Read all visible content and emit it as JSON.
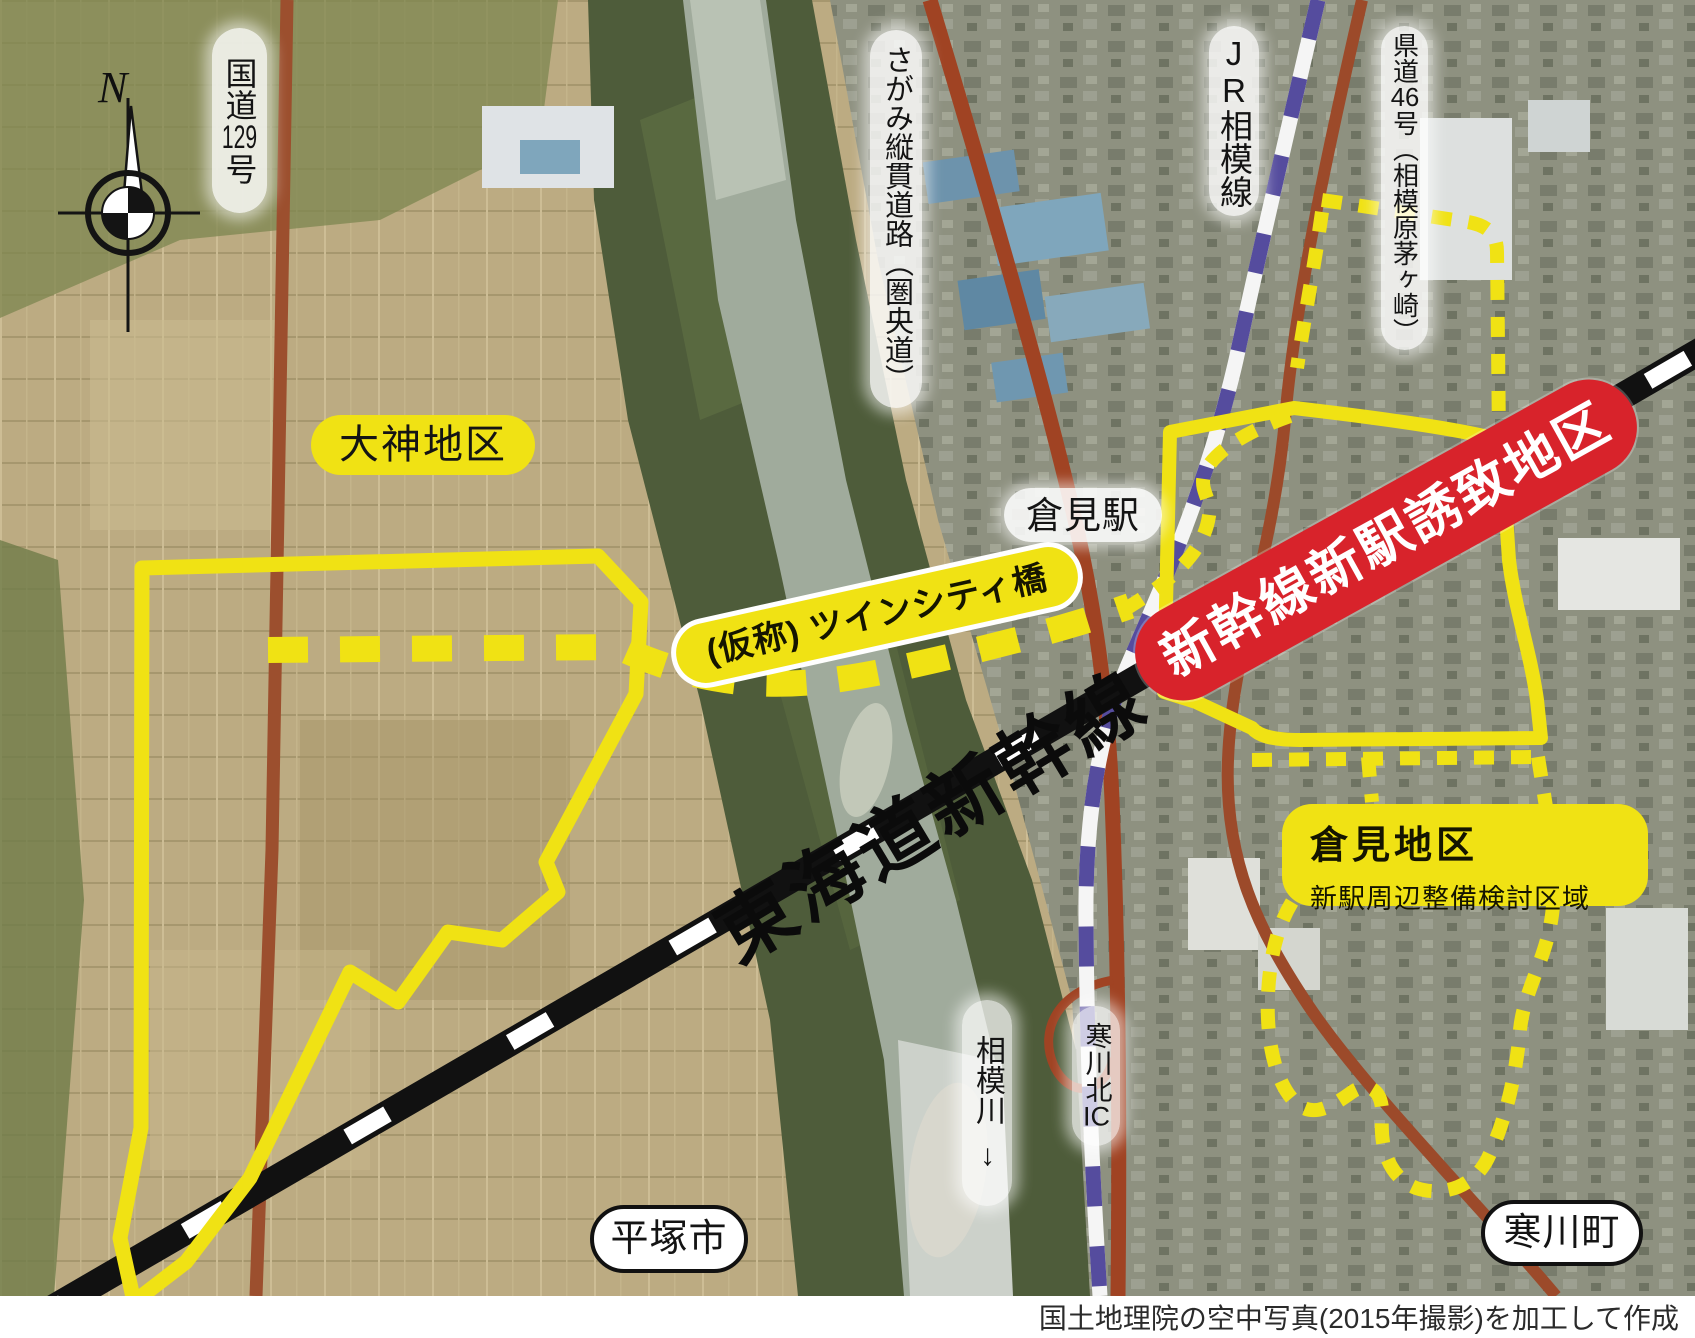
{
  "map": {
    "compass": {
      "label": "N"
    },
    "roads": {
      "route129": {
        "parts": [
          "国道",
          "129",
          "号"
        ]
      },
      "sagami_expressway": {
        "label": "さがみ縦貫道路（圏央道）"
      },
      "jr_sagami_line": {
        "parts": [
          "JR",
          "相模線"
        ]
      },
      "prefectural_route46": {
        "parts": [
          "県道",
          "46",
          "号（相模原茅ヶ崎）"
        ]
      }
    },
    "districts": {
      "okami": {
        "label": "大神地区"
      },
      "kurami": {
        "title": "倉見地区",
        "subtitle": "新駅周辺整備検討区域"
      },
      "station_attraction": {
        "label": "新幹線新駅誘致地区"
      }
    },
    "stations": {
      "kurami_station": {
        "label": "倉見駅"
      }
    },
    "rail": {
      "tokaido_shinkansen": {
        "label": "東海道新幹線"
      }
    },
    "bridge": {
      "twin_city": {
        "label": "(仮称) ツインシティ橋"
      }
    },
    "river": {
      "sagami_river": {
        "label": "相模川",
        "arrow": "↓"
      }
    },
    "interchange": {
      "samukawa_kita": {
        "parts": [
          "寒川北",
          "IC"
        ]
      }
    },
    "municipalities": {
      "hiratsuka": {
        "label": "平塚市"
      },
      "samukawa": {
        "label": "寒川町"
      }
    },
    "credit": "国土地理院の空中写真(2015年撮影)を加工して作成",
    "colors": {
      "boundary_yellow": "#f0e214",
      "attraction_red": "#d8232b",
      "road_brown": "#9c4a2a",
      "jr_purple": "#554c9e",
      "shinkansen_black": "#111111"
    }
  }
}
